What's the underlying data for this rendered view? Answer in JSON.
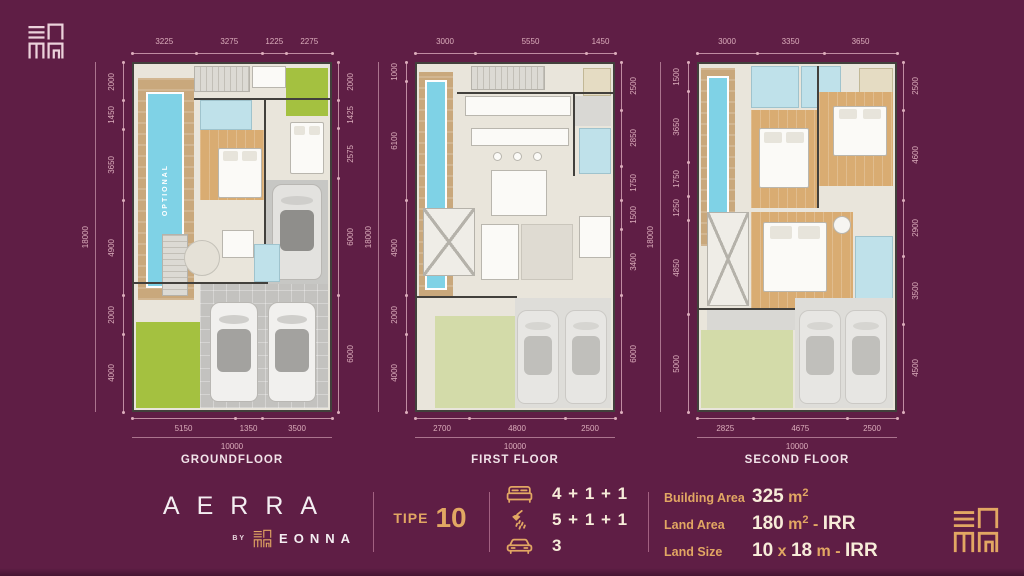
{
  "page": {
    "background": "#5f1e45",
    "gold": "#e2a763",
    "cream": "#f7ecd9",
    "white": "#f4eef2",
    "dim_pink": "#dcaebc"
  },
  "logos": {
    "top_left": "eonna-seal-logo",
    "bottom_right": "eonna-seal-logo"
  },
  "floors": [
    {
      "name": "GROUNDFLOOR",
      "top": [
        3225,
        3275,
        1225,
        2275
      ],
      "bottom": [
        5150,
        1350,
        3500
      ],
      "left": [
        2000,
        1450,
        3650,
        4900,
        2000,
        4000
      ],
      "right": [
        2000,
        1425,
        2575,
        6000,
        6000
      ],
      "width_total": "10000",
      "height_total": "18000",
      "pool_label": "OPTIONAL"
    },
    {
      "name": "FIRST FLOOR",
      "top": [
        3000,
        5550,
        1450
      ],
      "bottom": [
        2700,
        4800,
        2500
      ],
      "left": [
        1000,
        6100,
        4900,
        2000,
        4000
      ],
      "right": [
        2500,
        2850,
        1750,
        1500,
        3400,
        6000
      ],
      "width_total": "10000",
      "height_total": "18000"
    },
    {
      "name": "SECOND FLOOR",
      "top": [
        3000,
        3350,
        3650
      ],
      "bottom": [
        2825,
        4675,
        2500
      ],
      "left": [
        1500,
        3650,
        1750,
        1250,
        4850,
        5000
      ],
      "right": [
        2500,
        4600,
        2900,
        3500,
        4500
      ],
      "width_total": "10000",
      "height_total": "18000"
    }
  ],
  "branding": {
    "name": "AERRA",
    "by": "BY",
    "company": "EONNA",
    "type_label": "TIPE",
    "type_number": "10"
  },
  "specs": [
    {
      "icon": "bed-icon",
      "value": "4 + 1 + 1"
    },
    {
      "icon": "shower-icon",
      "value": "5 + 1 + 1"
    },
    {
      "icon": "car-icon",
      "value": "3"
    }
  ],
  "areas": [
    {
      "label": "Building Area",
      "parts": [
        {
          "text": "325",
          "style": "num"
        },
        {
          "text": " m",
          "style": "unit"
        },
        {
          "text": "2",
          "style": "sup"
        }
      ]
    },
    {
      "label": "Land Area",
      "parts": [
        {
          "text": "180",
          "style": "num"
        },
        {
          "text": " m",
          "style": "unit"
        },
        {
          "text": "2",
          "style": "sup"
        },
        {
          "text": " - ",
          "style": "unit"
        },
        {
          "text": "IRR",
          "style": "num"
        }
      ]
    },
    {
      "label": "Land Size",
      "parts": [
        {
          "text": "10",
          "style": "num"
        },
        {
          "text": " x ",
          "style": "unit"
        },
        {
          "text": "18",
          "style": "num"
        },
        {
          "text": " m - ",
          "style": "unit"
        },
        {
          "text": "IRR",
          "style": "num"
        }
      ]
    }
  ]
}
